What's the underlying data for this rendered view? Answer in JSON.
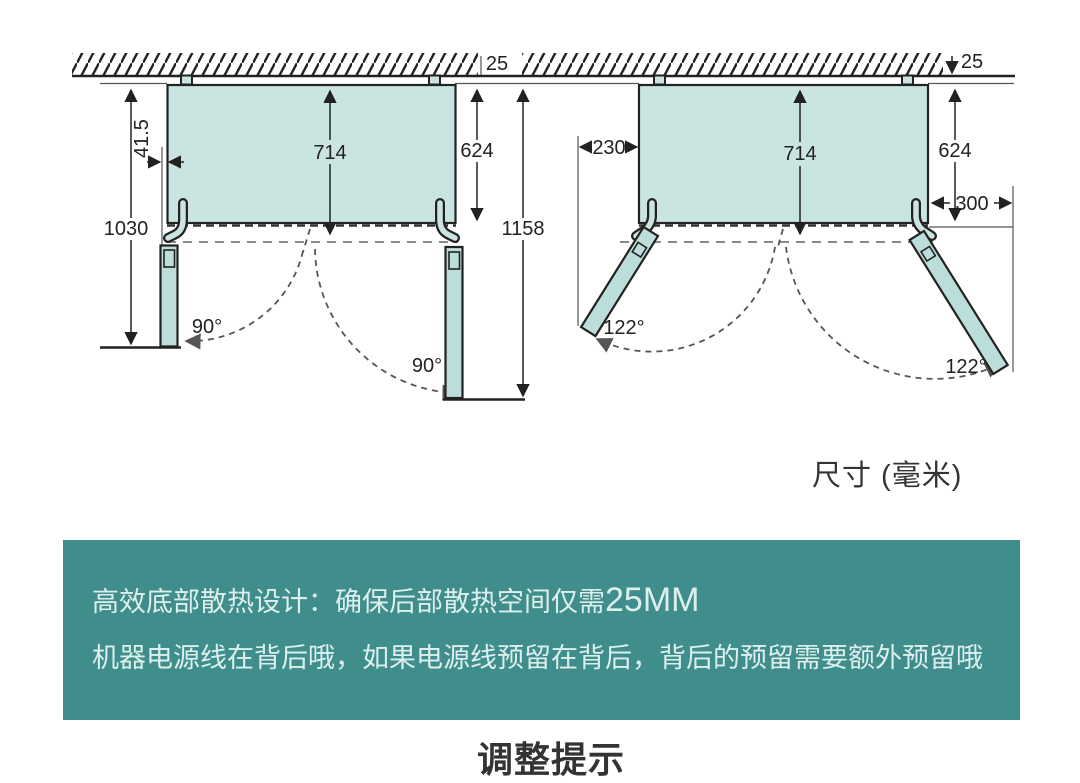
{
  "caption": {
    "text": "尺寸 (毫米)"
  },
  "left_view": {
    "back_clearance": "25",
    "hinge_gap": "41.5",
    "fridge_depth": "714",
    "cabinet_depth": "624",
    "depth_left_door_open": "1030",
    "depth_right_door_open": "1158",
    "left_door_angle": "90°",
    "right_door_angle": "90°"
  },
  "right_view": {
    "back_clearance": "25",
    "left_side_clearance": "230",
    "fridge_depth": "714",
    "cabinet_depth": "624",
    "right_side_clearance": "300",
    "left_door_angle": "122°",
    "right_door_angle": "122°"
  },
  "banner": {
    "bg_color": "#3f8e8b",
    "text_color": "#ddefec",
    "line1_prefix": "高效底部散热设计：确保后部散热空间仅需",
    "line1_value": "25MM",
    "line2": "机器电源线在背后哦，如果电源线预留在背后，背后的预留需要额外预留哦"
  },
  "footer": {
    "partial_title": "调整提示"
  }
}
